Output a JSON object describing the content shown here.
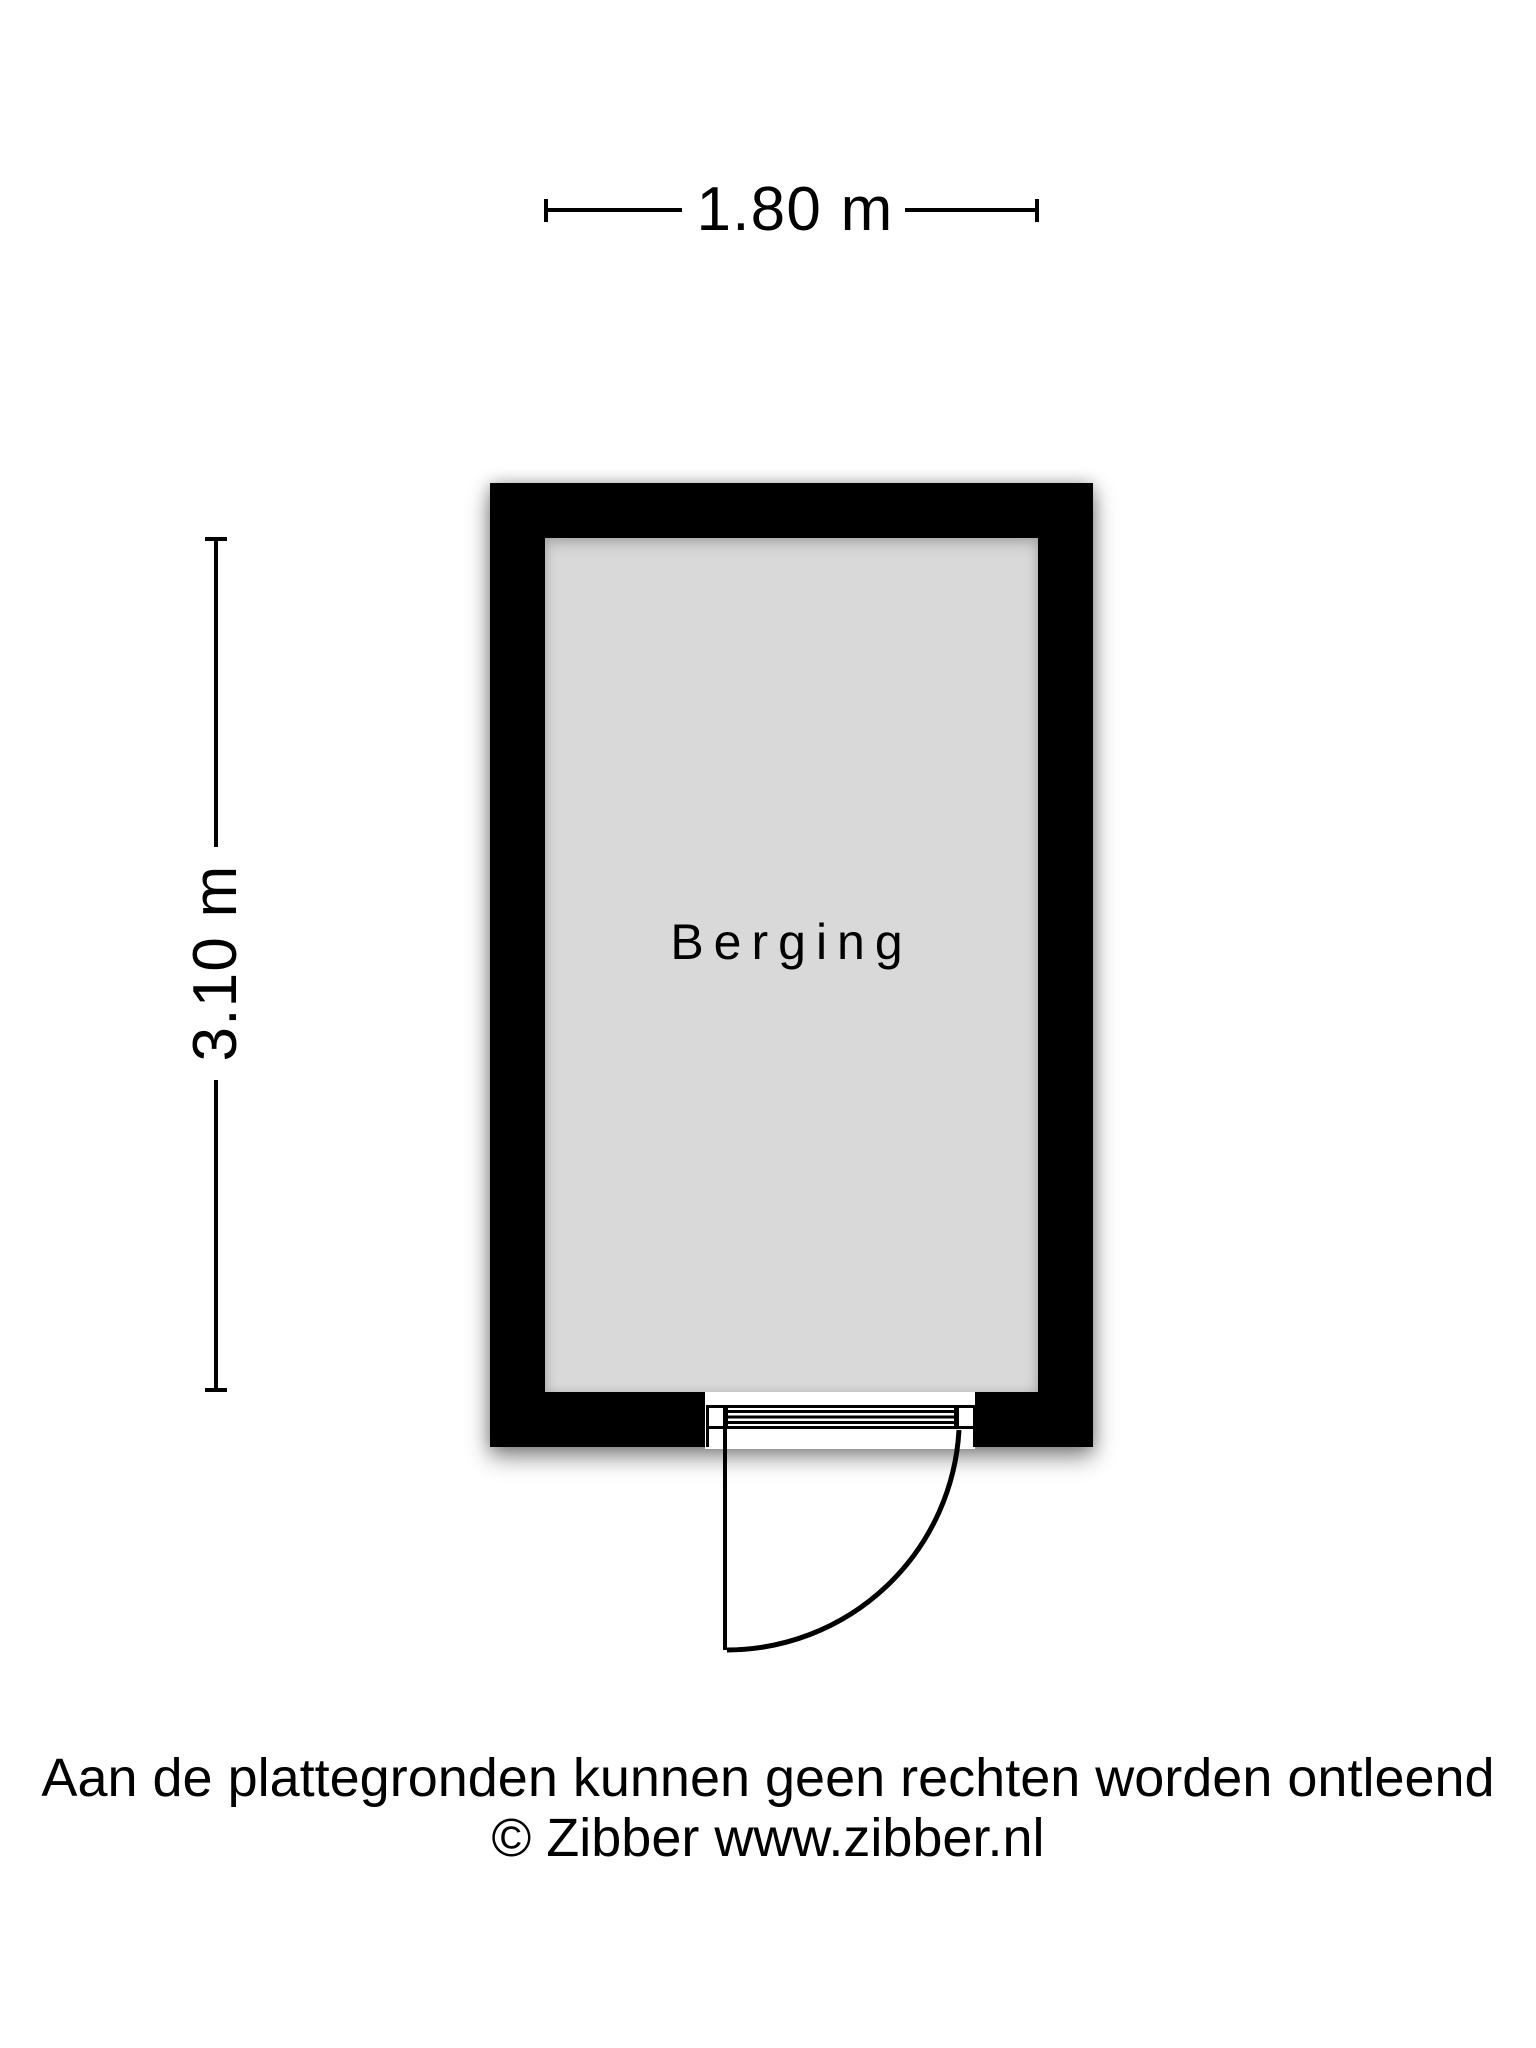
{
  "floorplan": {
    "room": {
      "name": "Berging"
    },
    "dimensions": {
      "width_label": "1.80 m",
      "height_label": "3.10 m"
    },
    "colors": {
      "wall": "#000000",
      "floor": "#d9d9d9",
      "background": "#ffffff",
      "text": "#000000"
    }
  },
  "footer": {
    "line1": "Aan de plattegronden kunnen geen rechten worden ontleend",
    "line2": "© Zibber www.zibber.nl"
  }
}
